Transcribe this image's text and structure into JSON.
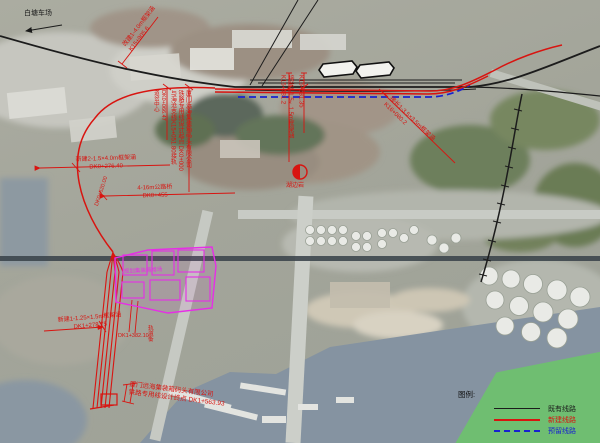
{
  "map": {
    "colors": {
      "existing_rail": "#1c1c1c",
      "new_rail": "#d81410",
      "reserved_rail": "#1822cf",
      "planned_yard": "#e62ee6",
      "legend_background": "#6ec26e"
    },
    "annotations": {
      "station": "白塘车场",
      "culvert_b": "改建1-4.0m框架涵\nK15+905.6",
      "switch_c": "DK0+066.47\n道岔中心",
      "start_point": "厦门远海集装箱码头有限公司\n铁路专用线设计起点 DK0+000\n与海沧支线K15+051.80接轨",
      "culvert_f": "接长1-1.5×1.5m框架涵\nK15+481.2",
      "culvert_g": "K15+631.35",
      "culvert_h": "接长1-3.5×3.5m框架涵\nK16+080.2",
      "culvert_i": "新建2-1.5×4.0m框架涵\nDK0+276.40",
      "bridge_j": "4-16m公路桥\nDK0+455",
      "curve_k": "DK0+620.00",
      "culvert_l": "新建1-1.25×1.5m框架涵\nDK1+278.75",
      "scale_m_mileage": "DK1+382.10",
      "scale_m_name": "轨道衡",
      "end_point": "厦门远海集装箱码头有限公司\n铁路专用线设计终点 DK1+563.93",
      "control_point": "湖边岩",
      "yard_label": "规划集装箱堆场"
    },
    "legend": {
      "title": "图例:",
      "items": [
        {
          "label": "既有线路",
          "color": "#1c1c1c",
          "style": "solid"
        },
        {
          "label": "新建线路",
          "color": "#d81410",
          "style": "solid"
        },
        {
          "label": "预留线路",
          "color": "#1822cf",
          "style": "dashed"
        }
      ]
    }
  }
}
